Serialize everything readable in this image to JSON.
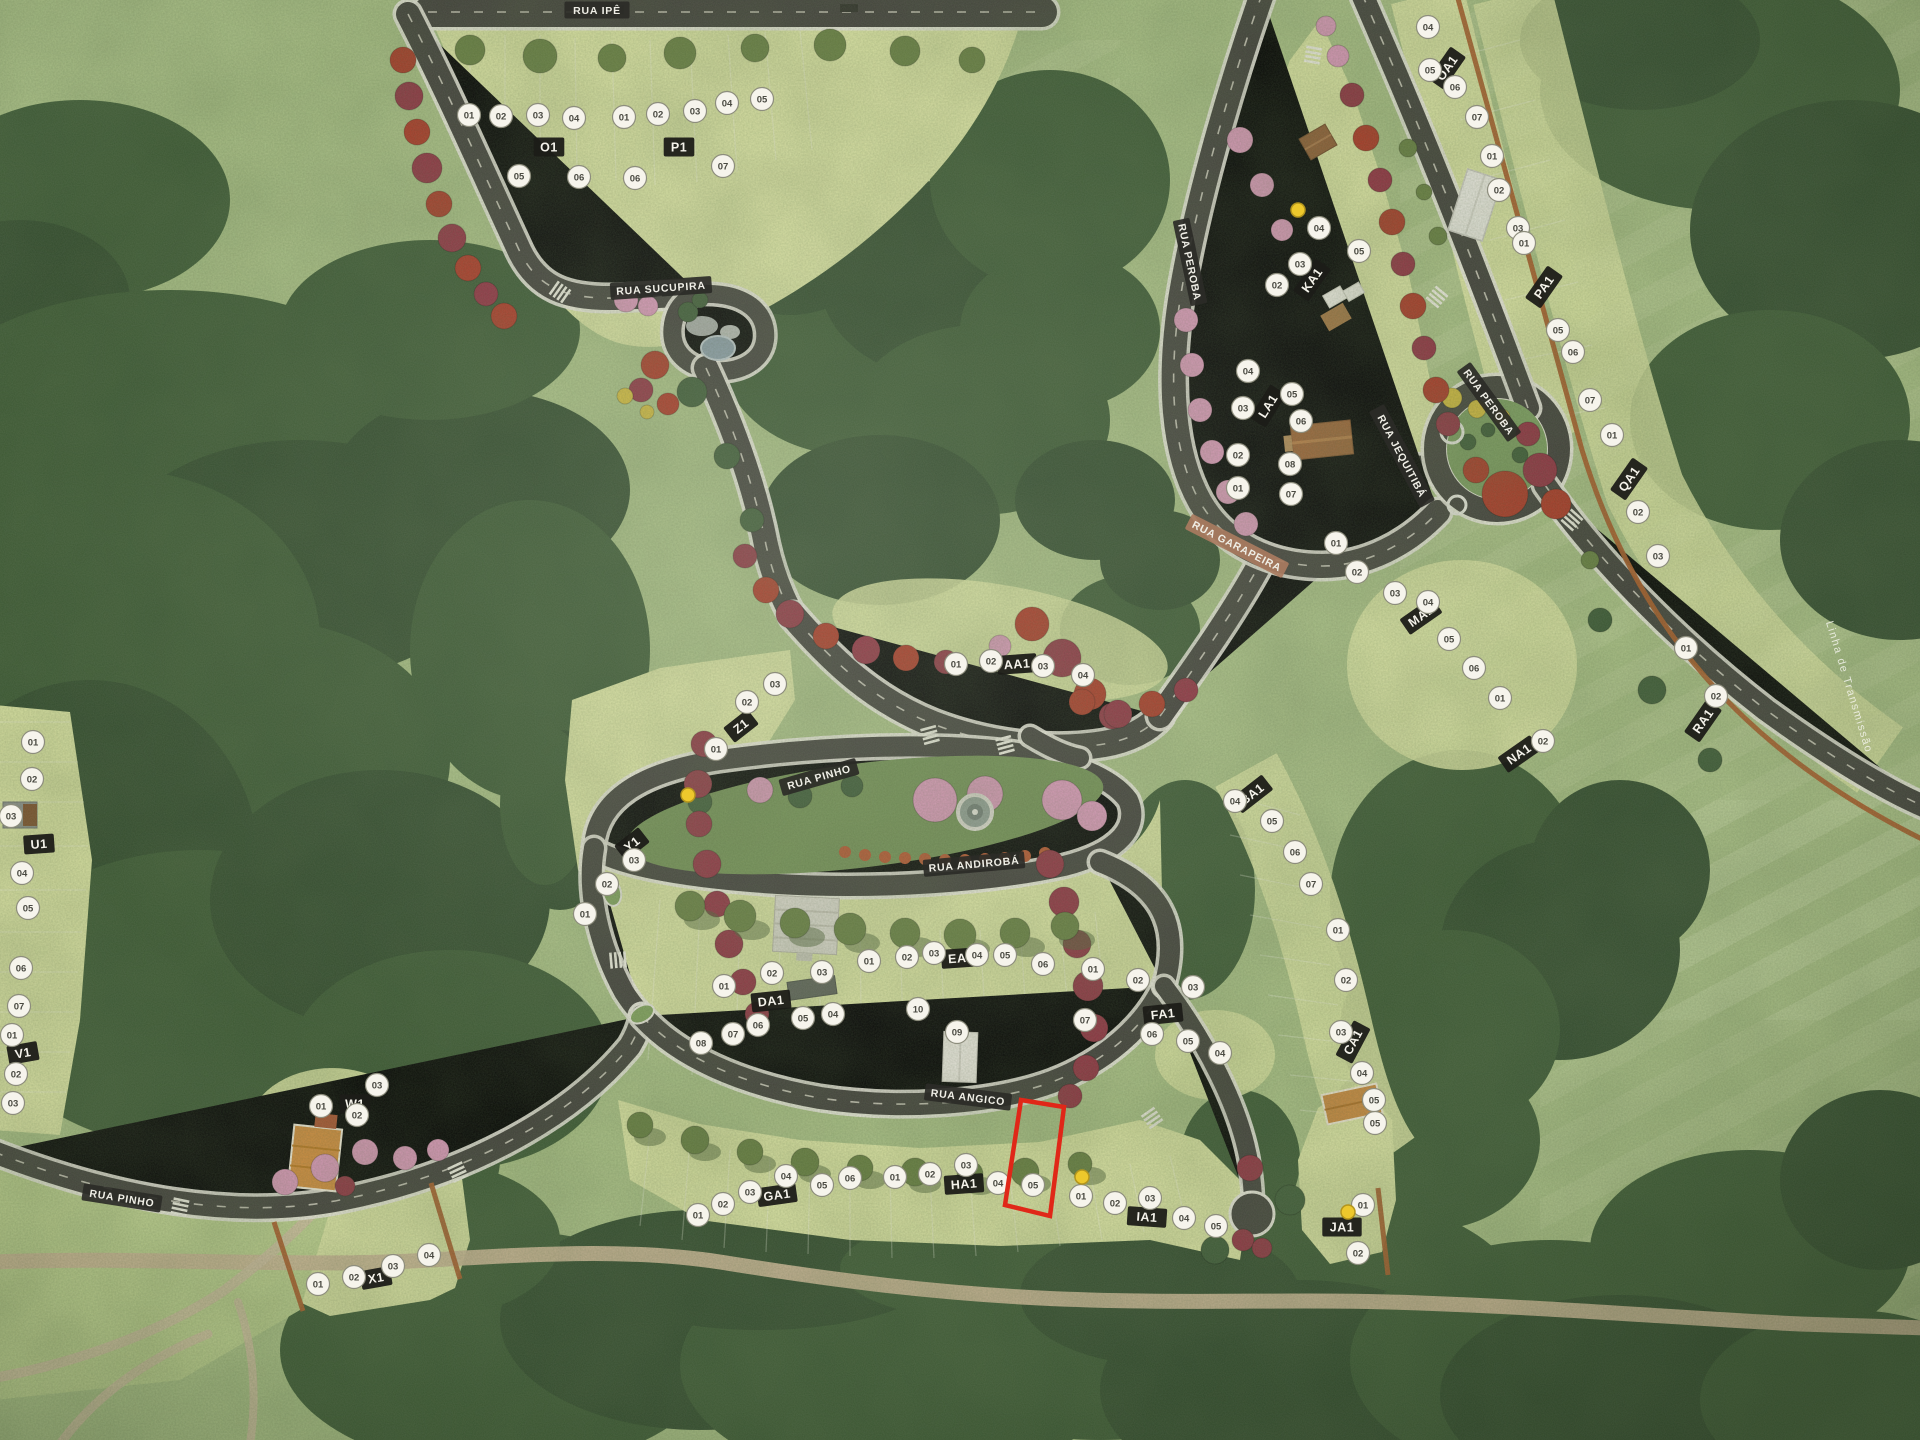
{
  "scene": {
    "description": "Aerial photo of a physical scale model of a residential land development (loteamento) with named streets, block plaques and numbered lot markers",
    "highlight_color": "#e02718",
    "sold_marker_color": "#edc82c",
    "plaque_color": "#2b2b27",
    "tan_plaque_color": "#a97b60"
  },
  "streets": [
    {
      "name": "RUA IPÊ",
      "x": 597,
      "y": 10,
      "rot": 0,
      "style": "dark"
    },
    {
      "name": "RUA SUCUPIRA",
      "x": 661,
      "y": 288,
      "rot": -4,
      "style": "dark"
    },
    {
      "name": "RUA PEROBA",
      "x": 1190,
      "y": 262,
      "rot": 78,
      "style": "dark"
    },
    {
      "name": "RUA PEROBA",
      "x": 1489,
      "y": 402,
      "rot": 54,
      "style": "dark"
    },
    {
      "name": "RUA JEQUITIBÁ",
      "x": 1402,
      "y": 456,
      "rot": 62,
      "style": "dark"
    },
    {
      "name": "RUA GARAPEIRA",
      "x": 1237,
      "y": 546,
      "rot": 27,
      "style": "tan"
    },
    {
      "name": "RUA PINHO",
      "x": 819,
      "y": 777,
      "rot": -16,
      "style": "dark"
    },
    {
      "name": "RUA ANDIROBÁ",
      "x": 974,
      "y": 864,
      "rot": -5,
      "style": "dark"
    },
    {
      "name": "RUA ANGICO",
      "x": 968,
      "y": 1097,
      "rot": 7,
      "style": "dark"
    },
    {
      "name": "RUA PINHO",
      "x": 122,
      "y": 1198,
      "rot": 9,
      "style": "dark"
    }
  ],
  "edge_note": {
    "text": "Linha de Transmissão",
    "x": 1846,
    "y": 688,
    "rot": 73
  },
  "blocks": [
    {
      "id": "O1",
      "x": 549,
      "y": 147,
      "rot": 0
    },
    {
      "id": "P1",
      "x": 679,
      "y": 147,
      "rot": 0
    },
    {
      "id": "U1",
      "x": 39,
      "y": 844,
      "rot": -4
    },
    {
      "id": "V1",
      "x": 23,
      "y": 1053,
      "rot": -10
    },
    {
      "id": "W1",
      "x": 355,
      "y": 1104,
      "rot": 0
    },
    {
      "id": "X1",
      "x": 376,
      "y": 1278,
      "rot": -10
    },
    {
      "id": "Y1",
      "x": 632,
      "y": 844,
      "rot": -38
    },
    {
      "id": "Z1",
      "x": 741,
      "y": 726,
      "rot": -38
    },
    {
      "id": "AA1",
      "x": 1017,
      "y": 664,
      "rot": -4
    },
    {
      "id": "BA1",
      "x": 1252,
      "y": 794,
      "rot": -38
    },
    {
      "id": "CA1",
      "x": 1353,
      "y": 1042,
      "rot": -62
    },
    {
      "id": "DA1",
      "x": 771,
      "y": 1001,
      "rot": -6
    },
    {
      "id": "EA1",
      "x": 961,
      "y": 958,
      "rot": -4
    },
    {
      "id": "FA1",
      "x": 1163,
      "y": 1014,
      "rot": -6
    },
    {
      "id": "GA1",
      "x": 777,
      "y": 1195,
      "rot": -8
    },
    {
      "id": "HA1",
      "x": 964,
      "y": 1184,
      "rot": -4
    },
    {
      "id": "IA1",
      "x": 1147,
      "y": 1217,
      "rot": 4
    },
    {
      "id": "JA1",
      "x": 1342,
      "y": 1227,
      "rot": 0
    },
    {
      "id": "KA1",
      "x": 1312,
      "y": 280,
      "rot": -55
    },
    {
      "id": "LA1",
      "x": 1268,
      "y": 406,
      "rot": -58
    },
    {
      "id": "MA1",
      "x": 1421,
      "y": 616,
      "rot": -35
    },
    {
      "id": "NA1",
      "x": 1519,
      "y": 754,
      "rot": -35
    },
    {
      "id": "OA1",
      "x": 1447,
      "y": 68,
      "rot": -55
    },
    {
      "id": "PA1",
      "x": 1544,
      "y": 287,
      "rot": -55
    },
    {
      "id": "QA1",
      "x": 1629,
      "y": 479,
      "rot": -55
    },
    {
      "id": "RA1",
      "x": 1703,
      "y": 721,
      "rot": -55
    }
  ],
  "lots": [
    {
      "b": "O1",
      "n": "01",
      "x": 469,
      "y": 115
    },
    {
      "b": "O1",
      "n": "02",
      "x": 501,
      "y": 116
    },
    {
      "b": "O1",
      "n": "03",
      "x": 538,
      "y": 115
    },
    {
      "b": "O1",
      "n": "04",
      "x": 574,
      "y": 118
    },
    {
      "b": "O1",
      "n": "05",
      "x": 519,
      "y": 176
    },
    {
      "b": "O1",
      "n": "06",
      "x": 579,
      "y": 177
    },
    {
      "b": "P1",
      "n": "01",
      "x": 624,
      "y": 117
    },
    {
      "b": "P1",
      "n": "02",
      "x": 658,
      "y": 114
    },
    {
      "b": "P1",
      "n": "03",
      "x": 695,
      "y": 111
    },
    {
      "b": "P1",
      "n": "04",
      "x": 727,
      "y": 103
    },
    {
      "b": "P1",
      "n": "05",
      "x": 762,
      "y": 99
    },
    {
      "b": "P1",
      "n": "06",
      "x": 635,
      "y": 178
    },
    {
      "b": "P1",
      "n": "07",
      "x": 723,
      "y": 166
    },
    {
      "b": "U1",
      "n": "01",
      "x": 33,
      "y": 742
    },
    {
      "b": "U1",
      "n": "02",
      "x": 32,
      "y": 779
    },
    {
      "b": "U1",
      "n": "03",
      "x": 11,
      "y": 816
    },
    {
      "b": "U1",
      "n": "04",
      "x": 22,
      "y": 873
    },
    {
      "b": "U1",
      "n": "05",
      "x": 28,
      "y": 908
    },
    {
      "b": "U1",
      "n": "06",
      "x": 21,
      "y": 968
    },
    {
      "b": "U1",
      "n": "07",
      "x": 19,
      "y": 1006
    },
    {
      "b": "V1",
      "n": "01",
      "x": 12,
      "y": 1035
    },
    {
      "b": "V1",
      "n": "02",
      "x": 16,
      "y": 1074
    },
    {
      "b": "V1",
      "n": "03",
      "x": 13,
      "y": 1103
    },
    {
      "b": "W1",
      "n": "01",
      "x": 321,
      "y": 1106
    },
    {
      "b": "W1",
      "n": "02",
      "x": 357,
      "y": 1115
    },
    {
      "b": "W1",
      "n": "03",
      "x": 377,
      "y": 1085
    },
    {
      "b": "X1",
      "n": "01",
      "x": 318,
      "y": 1284
    },
    {
      "b": "X1",
      "n": "02",
      "x": 354,
      "y": 1277
    },
    {
      "b": "X1",
      "n": "03",
      "x": 393,
      "y": 1266
    },
    {
      "b": "X1",
      "n": "04",
      "x": 429,
      "y": 1255
    },
    {
      "b": "Y1",
      "n": "01",
      "x": 585,
      "y": 914
    },
    {
      "b": "Y1",
      "n": "02",
      "x": 607,
      "y": 884
    },
    {
      "b": "Y1",
      "n": "03",
      "x": 634,
      "y": 860
    },
    {
      "b": "Z1",
      "n": "01",
      "x": 716,
      "y": 749
    },
    {
      "b": "Z1",
      "n": "02",
      "x": 747,
      "y": 702
    },
    {
      "b": "Z1",
      "n": "03",
      "x": 775,
      "y": 684
    },
    {
      "b": "AA1",
      "n": "01",
      "x": 956,
      "y": 664
    },
    {
      "b": "AA1",
      "n": "02",
      "x": 991,
      "y": 661
    },
    {
      "b": "AA1",
      "n": "03",
      "x": 1043,
      "y": 666
    },
    {
      "b": "AA1",
      "n": "04",
      "x": 1083,
      "y": 675
    },
    {
      "b": "BA1",
      "n": "04",
      "x": 1235,
      "y": 801
    },
    {
      "b": "BA1",
      "n": "05",
      "x": 1272,
      "y": 821
    },
    {
      "b": "BA1",
      "n": "06",
      "x": 1295,
      "y": 852
    },
    {
      "b": "BA1",
      "n": "07",
      "x": 1311,
      "y": 884
    },
    {
      "b": "CA1",
      "n": "01",
      "x": 1338,
      "y": 930
    },
    {
      "b": "CA1",
      "n": "02",
      "x": 1346,
      "y": 980
    },
    {
      "b": "CA1",
      "n": "03",
      "x": 1341,
      "y": 1032
    },
    {
      "b": "CA1",
      "n": "04",
      "x": 1362,
      "y": 1073
    },
    {
      "b": "CA1",
      "n": "05",
      "x": 1375,
      "y": 1123
    },
    {
      "b": "DA1",
      "n": "01",
      "x": 724,
      "y": 986
    },
    {
      "b": "DA1",
      "n": "02",
      "x": 772,
      "y": 973
    },
    {
      "b": "DA1",
      "n": "03",
      "x": 822,
      "y": 972
    },
    {
      "b": "DA1",
      "n": "04",
      "x": 833,
      "y": 1014
    },
    {
      "b": "DA1",
      "n": "05",
      "x": 803,
      "y": 1018
    },
    {
      "b": "DA1",
      "n": "06",
      "x": 758,
      "y": 1025
    },
    {
      "b": "DA1",
      "n": "07",
      "x": 733,
      "y": 1034
    },
    {
      "b": "DA1",
      "n": "08",
      "x": 701,
      "y": 1043
    },
    {
      "b": "EA1",
      "n": "01",
      "x": 869,
      "y": 961
    },
    {
      "b": "EA1",
      "n": "02",
      "x": 907,
      "y": 957
    },
    {
      "b": "EA1",
      "n": "03",
      "x": 934,
      "y": 953
    },
    {
      "b": "EA1",
      "n": "04",
      "x": 977,
      "y": 955
    },
    {
      "b": "EA1",
      "n": "05",
      "x": 1005,
      "y": 955
    },
    {
      "b": "EA1",
      "n": "06",
      "x": 1043,
      "y": 964
    },
    {
      "b": "EA1",
      "n": "07",
      "x": 1085,
      "y": 1020
    },
    {
      "b": "EA1",
      "n": "09",
      "x": 957,
      "y": 1032
    },
    {
      "b": "EA1",
      "n": "10",
      "x": 918,
      "y": 1009
    },
    {
      "b": "FA1",
      "n": "01",
      "x": 1093,
      "y": 969
    },
    {
      "b": "FA1",
      "n": "02",
      "x": 1138,
      "y": 980
    },
    {
      "b": "FA1",
      "n": "03",
      "x": 1193,
      "y": 987
    },
    {
      "b": "FA1",
      "n": "04",
      "x": 1220,
      "y": 1053
    },
    {
      "b": "FA1",
      "n": "05",
      "x": 1188,
      "y": 1041
    },
    {
      "b": "FA1",
      "n": "06",
      "x": 1152,
      "y": 1034
    },
    {
      "b": "GA1",
      "n": "01",
      "x": 698,
      "y": 1215
    },
    {
      "b": "GA1",
      "n": "02",
      "x": 723,
      "y": 1204
    },
    {
      "b": "GA1",
      "n": "03",
      "x": 750,
      "y": 1192
    },
    {
      "b": "GA1",
      "n": "04",
      "x": 786,
      "y": 1176
    },
    {
      "b": "GA1",
      "n": "05",
      "x": 822,
      "y": 1185
    },
    {
      "b": "GA1",
      "n": "06",
      "x": 850,
      "y": 1178
    },
    {
      "b": "HA1",
      "n": "01",
      "x": 895,
      "y": 1177
    },
    {
      "b": "HA1",
      "n": "02",
      "x": 930,
      "y": 1174
    },
    {
      "b": "HA1",
      "n": "03",
      "x": 966,
      "y": 1165
    },
    {
      "b": "HA1",
      "n": "04",
      "x": 998,
      "y": 1183
    },
    {
      "b": "HA1",
      "n": "05",
      "x": 1033,
      "y": 1185
    },
    {
      "b": "IA1",
      "n": "01",
      "x": 1081,
      "y": 1196
    },
    {
      "b": "IA1",
      "n": "02",
      "x": 1115,
      "y": 1203
    },
    {
      "b": "IA1",
      "n": "03",
      "x": 1150,
      "y": 1198
    },
    {
      "b": "IA1",
      "n": "04",
      "x": 1184,
      "y": 1218
    },
    {
      "b": "IA1",
      "n": "05",
      "x": 1216,
      "y": 1226
    },
    {
      "b": "JA1",
      "n": "01",
      "x": 1363,
      "y": 1205
    },
    {
      "b": "JA1",
      "n": "02",
      "x": 1358,
      "y": 1253
    },
    {
      "b": "JA1",
      "n": "05",
      "x": 1374,
      "y": 1100
    },
    {
      "b": "KA1",
      "n": "02",
      "x": 1277,
      "y": 285
    },
    {
      "b": "KA1",
      "n": "03",
      "x": 1300,
      "y": 264
    },
    {
      "b": "KA1",
      "n": "04",
      "x": 1319,
      "y": 228
    },
    {
      "b": "KA1",
      "n": "05",
      "x": 1359,
      "y": 251
    },
    {
      "b": "LA1",
      "n": "01",
      "x": 1238,
      "y": 488
    },
    {
      "b": "LA1",
      "n": "02",
      "x": 1238,
      "y": 455
    },
    {
      "b": "LA1",
      "n": "03",
      "x": 1243,
      "y": 408
    },
    {
      "b": "LA1",
      "n": "04",
      "x": 1248,
      "y": 371
    },
    {
      "b": "LA1",
      "n": "05",
      "x": 1292,
      "y": 394
    },
    {
      "b": "LA1",
      "n": "06",
      "x": 1301,
      "y": 421
    },
    {
      "b": "LA1",
      "n": "07",
      "x": 1291,
      "y": 494
    },
    {
      "b": "LA1",
      "n": "08",
      "x": 1290,
      "y": 464
    },
    {
      "b": "MA1",
      "n": "01",
      "x": 1336,
      "y": 543
    },
    {
      "b": "MA1",
      "n": "02",
      "x": 1357,
      "y": 572
    },
    {
      "b": "MA1",
      "n": "03",
      "x": 1395,
      "y": 593
    },
    {
      "b": "MA1",
      "n": "04",
      "x": 1428,
      "y": 602
    },
    {
      "b": "MA1",
      "n": "05",
      "x": 1449,
      "y": 639
    },
    {
      "b": "MA1",
      "n": "06",
      "x": 1474,
      "y": 668
    },
    {
      "b": "NA1",
      "n": "01",
      "x": 1500,
      "y": 698
    },
    {
      "b": "NA1",
      "n": "02",
      "x": 1543,
      "y": 741
    },
    {
      "b": "OA1",
      "n": "01",
      "x": 1492,
      "y": 156
    },
    {
      "b": "OA1",
      "n": "02",
      "x": 1499,
      "y": 190
    },
    {
      "b": "OA1",
      "n": "03",
      "x": 1518,
      "y": 228
    },
    {
      "b": "OA1",
      "n": "04",
      "x": 1428,
      "y": 27
    },
    {
      "b": "OA1",
      "n": "05",
      "x": 1430,
      "y": 70
    },
    {
      "b": "OA1",
      "n": "06",
      "x": 1455,
      "y": 87
    },
    {
      "b": "OA1",
      "n": "07",
      "x": 1477,
      "y": 117
    },
    {
      "b": "PA1",
      "n": "01",
      "x": 1524,
      "y": 243
    },
    {
      "b": "PA1",
      "n": "05",
      "x": 1558,
      "y": 330
    },
    {
      "b": "PA1",
      "n": "06",
      "x": 1573,
      "y": 352
    },
    {
      "b": "PA1",
      "n": "07",
      "x": 1590,
      "y": 400
    },
    {
      "b": "QA1",
      "n": "01",
      "x": 1612,
      "y": 435
    },
    {
      "b": "QA1",
      "n": "02",
      "x": 1638,
      "y": 512
    },
    {
      "b": "QA1",
      "n": "03",
      "x": 1658,
      "y": 556
    },
    {
      "b": "RA1",
      "n": "01",
      "x": 1686,
      "y": 648
    },
    {
      "b": "RA1",
      "n": "02",
      "x": 1716,
      "y": 696
    }
  ],
  "sold_markers": [
    {
      "x": 688,
      "y": 795
    },
    {
      "x": 1298,
      "y": 210
    },
    {
      "x": 1082,
      "y": 1177
    },
    {
      "x": 1348,
      "y": 1212
    }
  ],
  "highlight": {
    "block": "HA1",
    "lot": "05",
    "points": "1021,1100 1064,1107 1050,1216 1005,1205"
  }
}
